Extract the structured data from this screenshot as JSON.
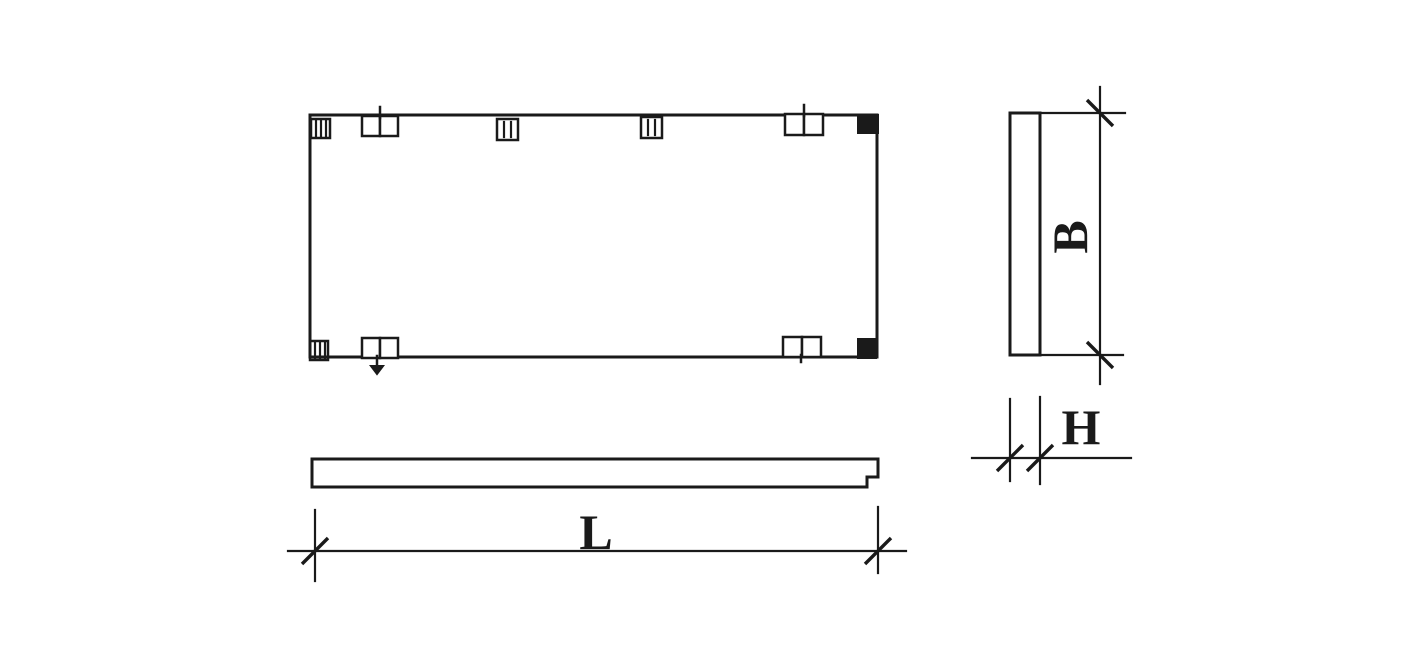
{
  "drawing": {
    "background_color": "#ffffff",
    "line_color": "#1a1a1a",
    "labels": {
      "length": "L",
      "width": "B",
      "thickness": "H"
    }
  }
}
